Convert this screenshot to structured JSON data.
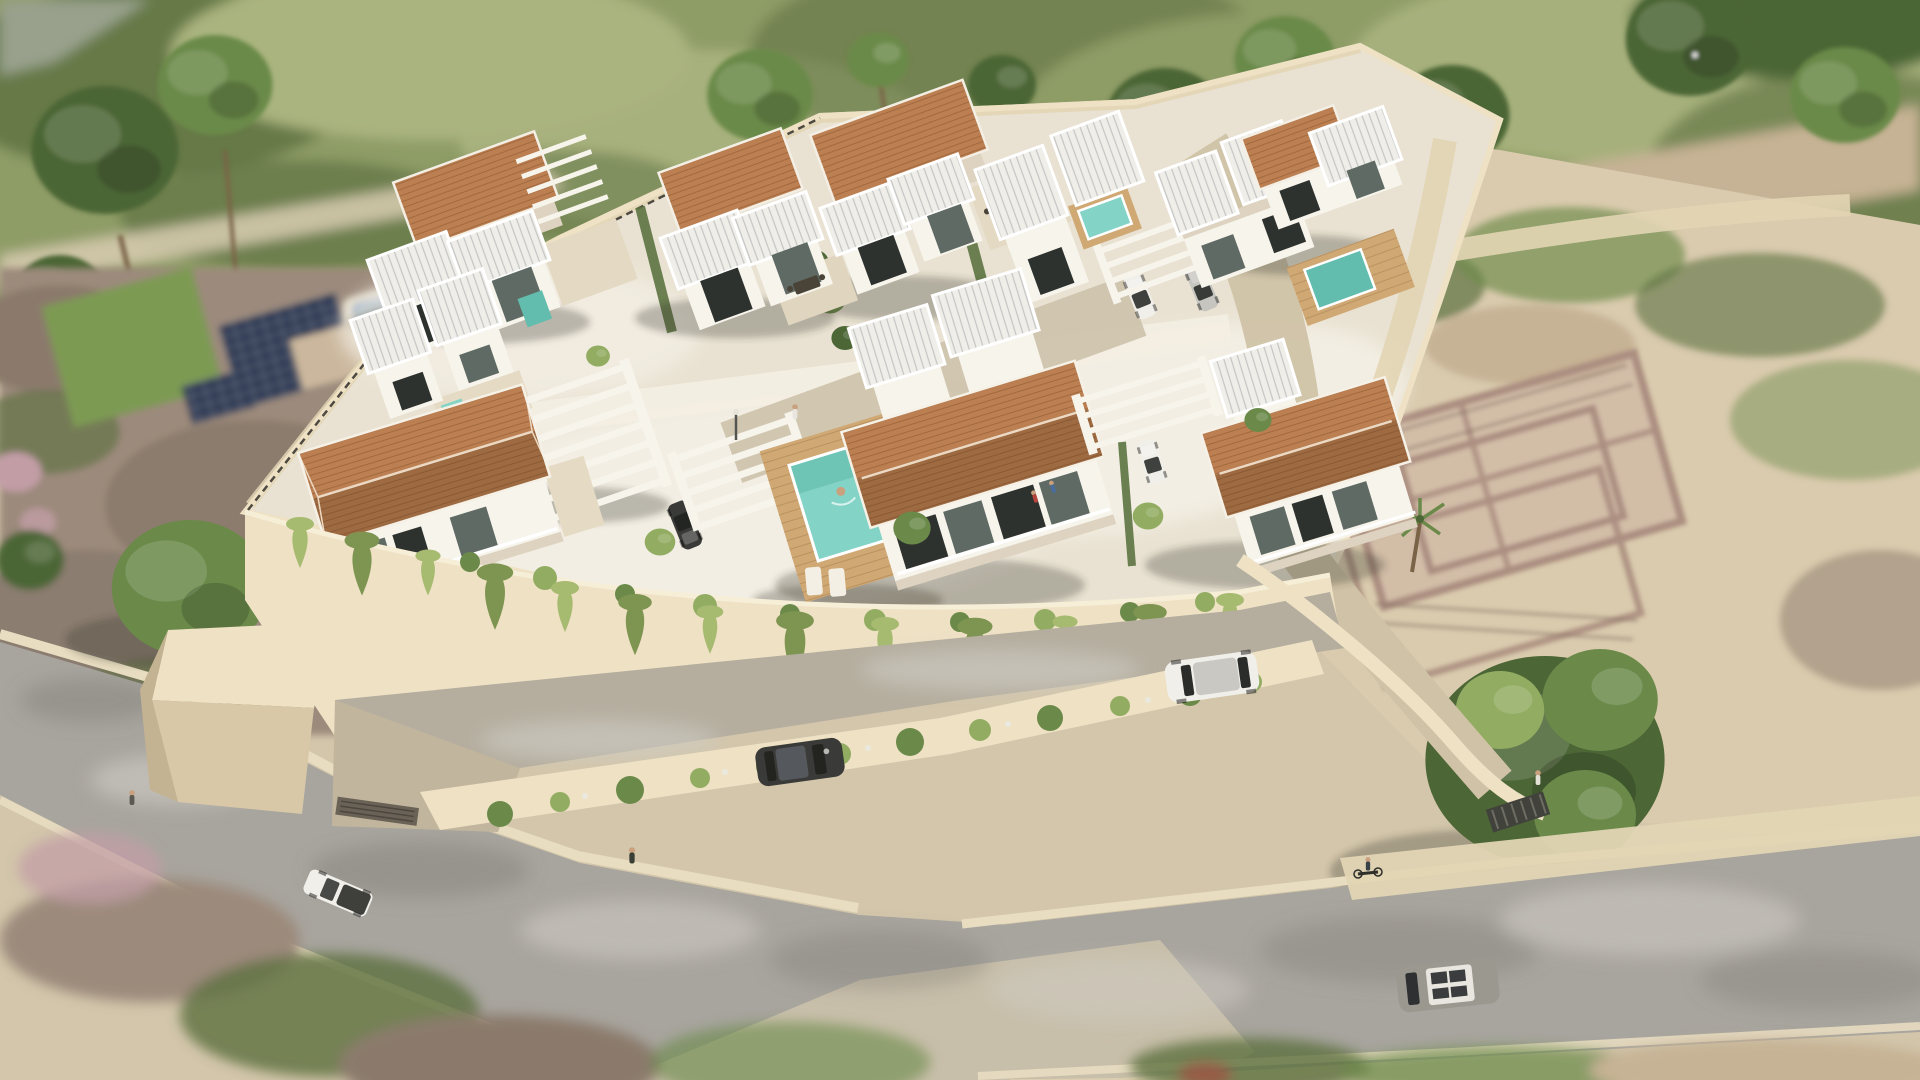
{
  "image": {
    "kind": "3D architectural rendering",
    "view": "aerial perspective, slightly rotated plan view",
    "description": "Aerial render of a walled residential development: white modern two-storey villas with terracotta hip roofs and white ribbed flat roofs, private pools with wood decks, white pergola carports with parked cars, a cream perimeter retaining wall draped with vines, surrounded by grey roads with vehicles, a neighbouring plot with blue pool and solar panels, scrubland with stone ruins, a large round tree and blurred green tree line at the top. No visible text, labels or UI elements.",
    "visible_text": "none"
  },
  "palette": {
    "sand_base": "#d3c6ab",
    "field_green": "#8e9c66",
    "field_dark": "#5c7040",
    "field_light": "#aab47f",
    "tree_dark": "#4c6636",
    "tree_mid": "#6b8a4a",
    "tree_light": "#92ac62",
    "trunk": "#7a6347",
    "path_pale": "#d8cdb2",
    "neighbor_earth": "#9c8a7b",
    "neighbor_earth2": "#8b7a6c",
    "lawn": "#7d9a52",
    "pool_blue": "#5d88b2",
    "pool_blue_light": "#7ba6c9",
    "solar": "#2d3a54",
    "blossom": "#c29da6",
    "road": "#a8a59e",
    "road_light": "#cfccc4",
    "road_dark": "#7e7b75",
    "curb": "#e8ddc1",
    "sidewalk": "#e2d5b4",
    "wall_cream": "#eee1c4",
    "wall_face": "#d9c8a7",
    "wall_shadow": "#c4b392",
    "ground": "#e9e2d2",
    "paving": "#f3eee3",
    "villa_white": "#f7f4ec",
    "villa_shade": "#ddd3c0",
    "villa_dark": "#c9bda7",
    "glass": "#5f6a64",
    "glass_dark": "#2e322e",
    "roof_terra": "#bc7f51",
    "roof_terra_dark": "#9d6a41",
    "roof_white": "#efeee9",
    "deck": "#cfa874",
    "pool_teal": "#83d3c6",
    "pool_teal_dark": "#63bdae",
    "vine": "#a6ba70",
    "vine_dark": "#7e9451",
    "hedge": "#5c7340",
    "sand_lot": "#dacbae",
    "dirt_path": "#c6b294",
    "ruin_wall": "#ab8e80",
    "ruin_shadow": "#7e6a5f",
    "ruin_fill": "#c8ae9f",
    "car_dark": "#3a3a38",
    "car_white": "#f1efe9",
    "car_silver": "#c6c5c0",
    "van_grey": "#9a988f",
    "gate_dark": "#42423c",
    "metal_fence": "#4e4a42",
    "shadow_col": "rgba(58,52,40,0.30)"
  },
  "objects": {
    "villas_with_terracotta_roofs": 7,
    "white_ribbed_roof_pavilions": 14,
    "pergola_carports": 4,
    "pools_inside_compound": 4,
    "neighbor_pool": 1,
    "solar_panel_arrays": 1,
    "cars_parked_inside": 5,
    "vehicles_on_roads": 4,
    "people": 7,
    "cyclists": 1,
    "stone_ruin_enclosures": 1,
    "large_trees": 16
  }
}
